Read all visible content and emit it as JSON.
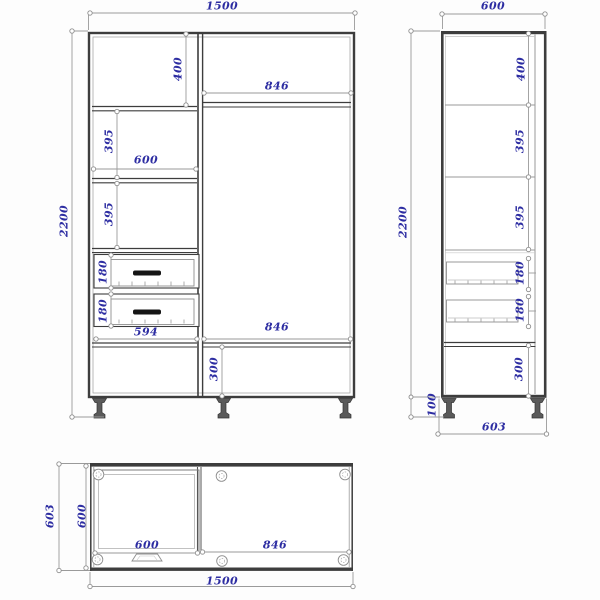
{
  "drawing": {
    "type": "furniture three-view technical drawing",
    "subject": "wardrobe cabinet",
    "colors": {
      "dimension_text": "#2d2da2",
      "body_line": "#3d3d3d",
      "dimension_line": "#9a9a9a",
      "background": "#fdfdfd"
    }
  },
  "views": {
    "front": {
      "name": "front elevation",
      "dims": {
        "overall_width": "1500",
        "overall_height": "2200",
        "top_section_height": "400",
        "door_top_width": "846",
        "shelf_section_height": "395",
        "left_unit_width": "600",
        "shelf_section2_height": "395",
        "drawer1_height": "180",
        "drawer2_height": "180",
        "drawer_front_width": "594",
        "door_bottom_width": "846",
        "bottom_section_height": "300"
      }
    },
    "side": {
      "name": "side elevation",
      "dims": {
        "overall_depth": "600",
        "overall_height": "2200",
        "top_section_height": "400",
        "shelf_section_height": "395",
        "shelf_section2_height": "395",
        "drawer1_height": "180",
        "drawer2_height": "180",
        "bottom_section_height": "300",
        "leg_height": "100",
        "depth_with_doors": "603"
      }
    },
    "top": {
      "name": "plan view",
      "dims": {
        "depth_with_doors": "603",
        "body_depth": "600",
        "inner_unit_width": "600",
        "door_width": "846",
        "overall_width": "1500"
      }
    }
  }
}
